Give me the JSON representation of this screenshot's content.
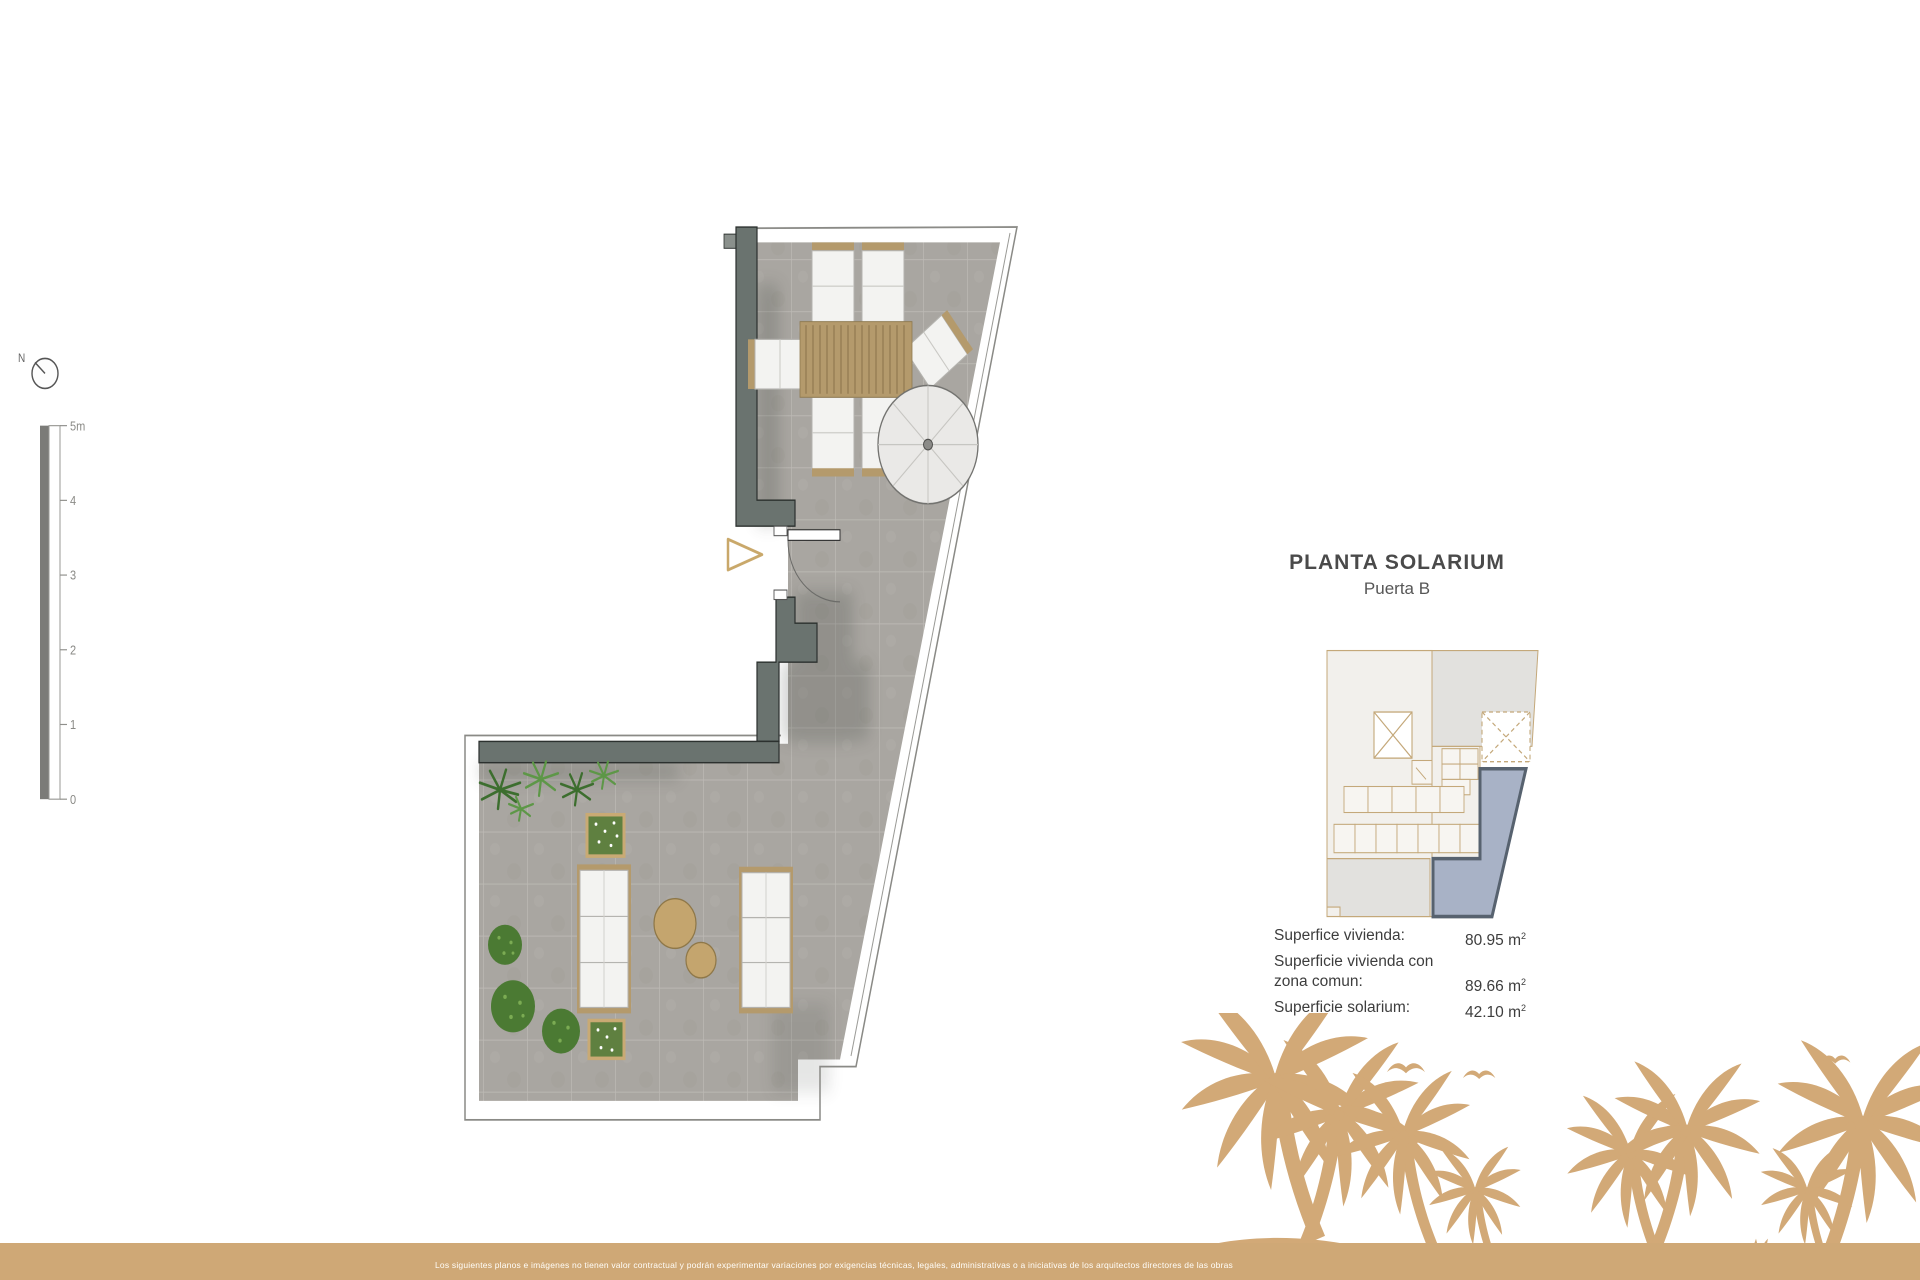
{
  "header": {
    "title": "PLANTA SOLARIUM",
    "subtitle": "Puerta B"
  },
  "areas": {
    "sup": "2",
    "rows": [
      {
        "label": "Superfice vivienda:",
        "value": "80.95 m"
      },
      {
        "label": "Superficie vivienda con",
        "value": ""
      },
      {
        "label": "zona comun:",
        "value": "89.66 m"
      },
      {
        "label": "Superficie solarium:",
        "value": "42.10 m"
      }
    ]
  },
  "compass": {
    "label": "N"
  },
  "scalebar": {
    "labels": [
      "5m",
      "4",
      "3",
      "2",
      "1",
      "0"
    ]
  },
  "footer": {
    "disclaimer": "Los siguientes planos e imágenes no tienen valor contractual y podrán experimentar variaciones por exigencias técnicas, legales, administrativas o a iniciativas de los arquitectos directores de las obras"
  },
  "colors": {
    "wall": "#6a736f",
    "tile": "#a9a6a1",
    "wood_accent": "#b49a6c",
    "entry_arrow": "#c9a86a",
    "key_unit_highlight": "#a8b2c6",
    "key_unit_border": "#57626f",
    "key_line_tan": "#c4a87a",
    "palm_illustration": "#d2a977",
    "footer_band": "#cfa876",
    "text_dark": "#3d3d3d"
  }
}
